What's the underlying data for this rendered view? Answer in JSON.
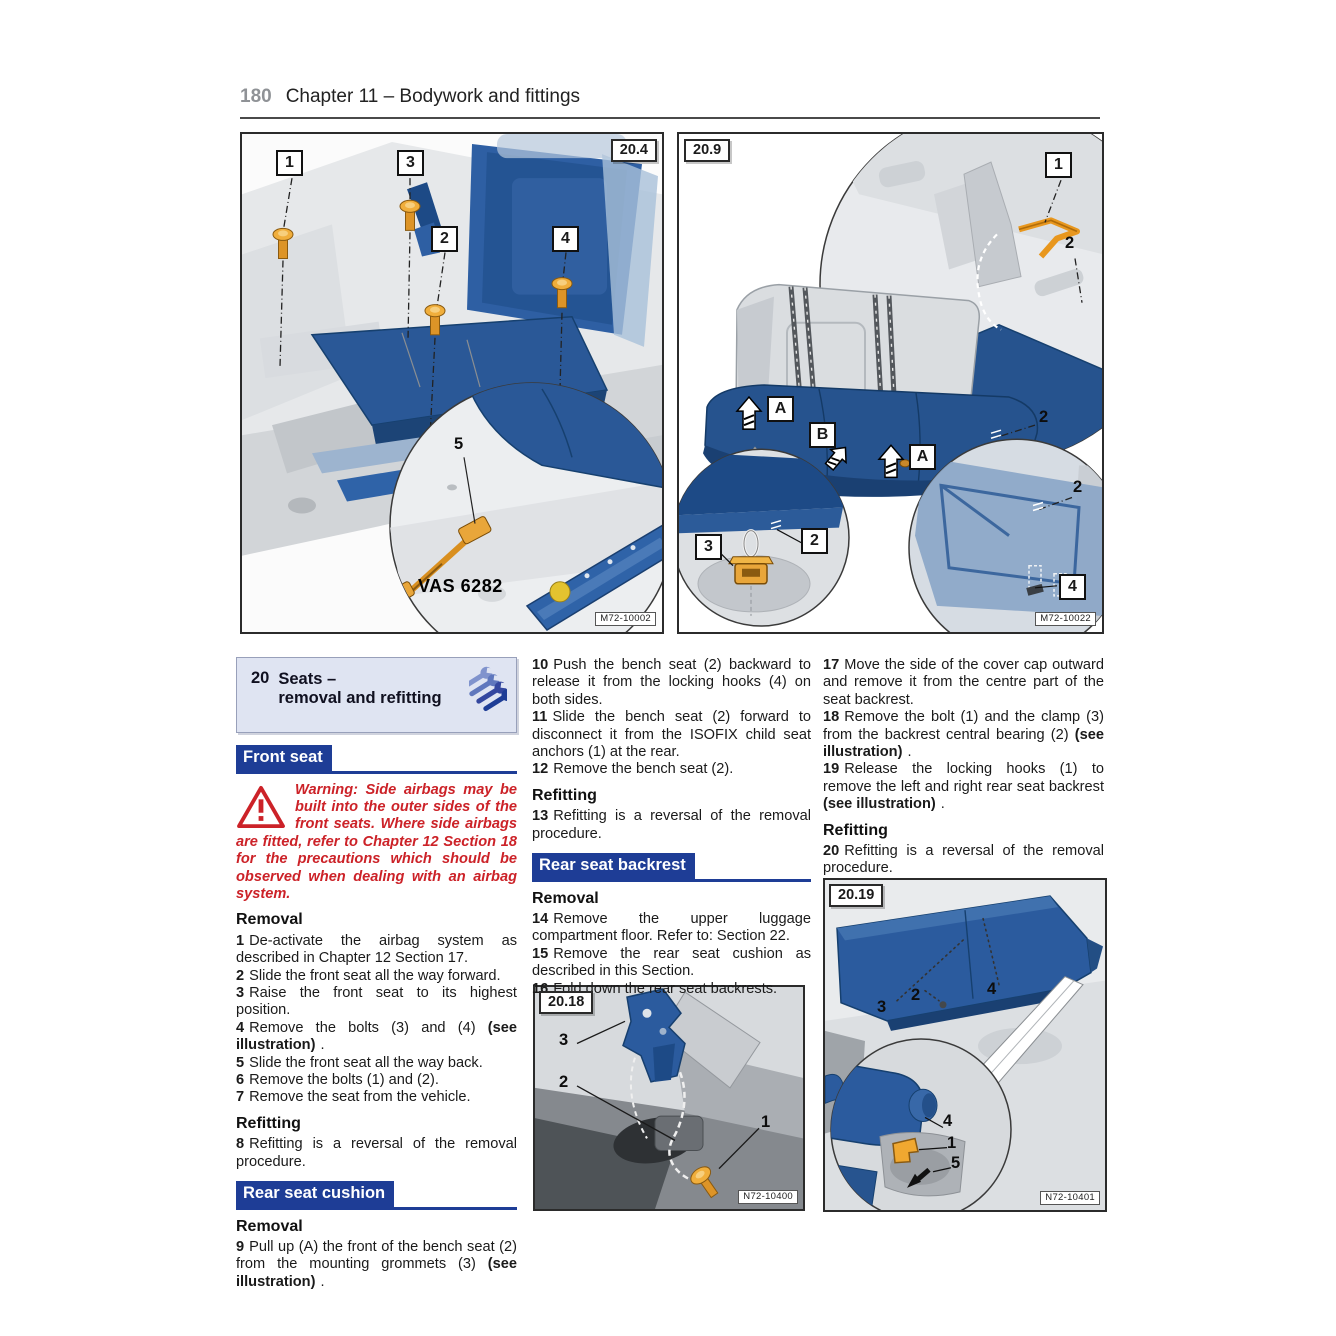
{
  "colors": {
    "accent_navy": "#1e3d96",
    "warning_red": "#cc2228",
    "seat_blue": "#2b5b9e",
    "bolt_orange": "#e9a63a",
    "floor_gray": "#d9dcdf"
  },
  "header": {
    "page_number": "180",
    "chapter_title": "Chapter 11 – Bodywork and fittings"
  },
  "figs": {
    "f204": {
      "label": "20.4",
      "c1": "1",
      "c2": "2",
      "c3": "3",
      "c4": "4",
      "c5": "5",
      "tool": "VAS 6282",
      "ref": "M72-10002"
    },
    "f209": {
      "label": "20.9",
      "i1": "1",
      "i2": "2",
      "a1": "A",
      "b": "B",
      "a2": "A",
      "bench2": "2",
      "g3": "3",
      "g2": "2",
      "p2": "2",
      "p4": "4",
      "ref": "M72-10022"
    },
    "f2018": {
      "label": "20.18",
      "c1": "1",
      "c2": "2",
      "c3": "3",
      "ref": "N72-10400"
    },
    "f2019": {
      "label": "20.19",
      "c2": "2",
      "c3": "3",
      "c4": "4",
      "i4": "4",
      "i1": "1",
      "i5": "5",
      "ref": "N72-10401"
    }
  },
  "left": {
    "section_number": "20",
    "section_title_l1": "Seats –",
    "section_title_l2": "removal and refitting",
    "front_seat_header": "Front seat",
    "warning": "Warning: Side airbags may be built into the outer sides of the front seats. Where side airbags are fitted, refer to Chapter 12 Section 18 for the precautions which should be observed when dealing with an airbag system.",
    "removal_heading": "Removal",
    "steps": [
      {
        "num": "1",
        "text": "De-activate the airbag system as described in Chapter 12 Section 17.",
        "bold": "",
        "tail": ""
      },
      {
        "num": "2",
        "text": "Slide the front seat all the way forward.",
        "bold": "",
        "tail": ""
      },
      {
        "num": "3",
        "text": "Raise the front seat to its highest position.",
        "bold": "",
        "tail": ""
      },
      {
        "num": "4",
        "text": "Remove the bolts (3) and (4) ",
        "bold": "(see illustration)",
        "tail": "."
      },
      {
        "num": "5",
        "text": "Slide the front seat all the way back.",
        "bold": "",
        "tail": ""
      },
      {
        "num": "6",
        "text": "Remove the bolts (1) and (2).",
        "bold": "",
        "tail": ""
      },
      {
        "num": "7",
        "text": "Remove the seat from the vehicle.",
        "bold": "",
        "tail": ""
      }
    ],
    "refitting_heading": "Refitting",
    "step8": {
      "num": "8",
      "text": "Refitting is a reversal of the removal procedure.",
      "bold": "",
      "tail": ""
    },
    "rear_cushion_header": "Rear seat cushion",
    "removal2_heading": "Removal",
    "step9": {
      "num": "9",
      "text": "Pull up (A) the front of the bench seat (2) from the mounting grommets (3) ",
      "bold": "(see illustration)",
      "tail": "."
    }
  },
  "middle": {
    "steps": [
      {
        "num": "10",
        "text": "Push the bench seat (2) backward to release it from the locking hooks (4) on both sides.",
        "bold": "",
        "tail": ""
      },
      {
        "num": "11",
        "text": "Slide the bench seat (2) forward to disconnect it from the ISOFIX child seat anchors (1) at the rear.",
        "bold": "",
        "tail": ""
      },
      {
        "num": "12",
        "text": "Remove the bench seat (2).",
        "bold": "",
        "tail": ""
      }
    ],
    "refitting_heading": "Refitting",
    "step13": {
      "num": "13",
      "text": "Refitting is a reversal of the removal procedure.",
      "bold": "",
      "tail": ""
    },
    "rear_backrest_header": "Rear seat backrest",
    "removal_heading": "Removal",
    "steps2": [
      {
        "num": "14",
        "text": "Remove the upper luggage compartment floor. Refer to: Section 22.",
        "bold": "",
        "tail": ""
      },
      {
        "num": "15",
        "text": "Remove the rear seat cushion as described in this Section.",
        "bold": "",
        "tail": ""
      },
      {
        "num": "16",
        "text": "Fold down the rear seat backrests.",
        "bold": "",
        "tail": ""
      }
    ]
  },
  "right": {
    "steps": [
      {
        "num": "17",
        "text": "Move the side of the cover cap outward and remove it from the centre part of the seat backrest.",
        "bold": "",
        "tail": ""
      },
      {
        "num": "18",
        "text": "Remove the bolt (1) and the clamp (3) from the backrest central bearing (2) ",
        "bold": "(see illustration)",
        "tail": "."
      },
      {
        "num": "19",
        "text": "Release the locking hooks (1) to remove the left and right rear seat backrest ",
        "bold": "(see illustration)",
        "tail": "."
      }
    ],
    "refitting_heading": "Refitting",
    "step20": {
      "num": "20",
      "text": "Refitting is a reversal of the removal procedure.",
      "bold": "",
      "tail": ""
    }
  }
}
